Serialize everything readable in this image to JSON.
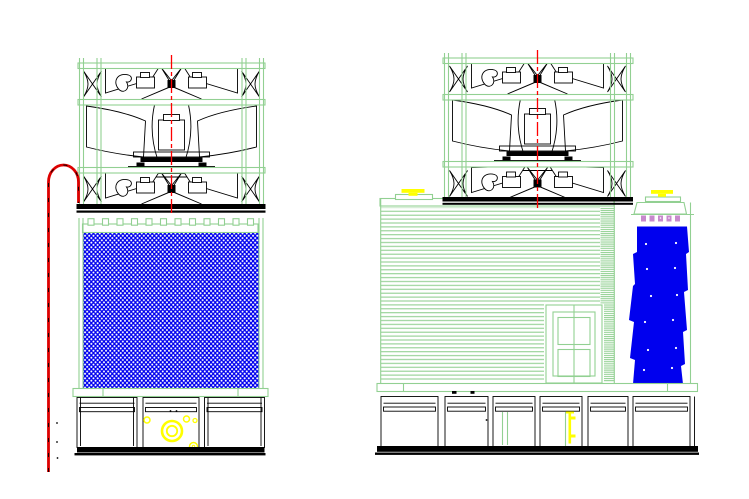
{
  "drawing": {
    "type": "cad-elevation-drawing",
    "subject": "induced-draft-cooling-tower",
    "views": [
      {
        "id": "front-elevation",
        "components": [
          "mechanical-frame",
          "axial-fan-upper",
          "axial-fan-lower",
          "fan-motor",
          "gear-drive-base",
          "fan-deck",
          "distribution-deck-slats",
          "fill-media-hatch",
          "collection-basin",
          "basin-panel-left",
          "basin-panel-middle",
          "basin-panel-right",
          "suction-ring-fitting",
          "drain-fittings",
          "riser-gooseneck-pipe",
          "vertical-centerline"
        ]
      },
      {
        "id": "side-elevation",
        "components": [
          "mechanical-frame",
          "axial-fan-upper",
          "axial-fan-lower",
          "fan-motor",
          "gear-drive-base",
          "fan-deck",
          "casing-cladding-lines",
          "access-door",
          "corner-louver-strip",
          "vent-cap-left",
          "vent-cap-right",
          "inlet-water-box",
          "spray-nozzles",
          "cascade-panel",
          "collection-basin",
          "basin-panels",
          "drain-valve",
          "vertical-centerline"
        ]
      }
    ]
  },
  "colors": {
    "green": "#92d092",
    "blue": "#0000ee",
    "yellow": "#ffff00",
    "red": "#ff0000",
    "pipe_red": "#dd0000",
    "orchid": "#c789cc",
    "black": "#000000",
    "bg": "#ffffff"
  }
}
